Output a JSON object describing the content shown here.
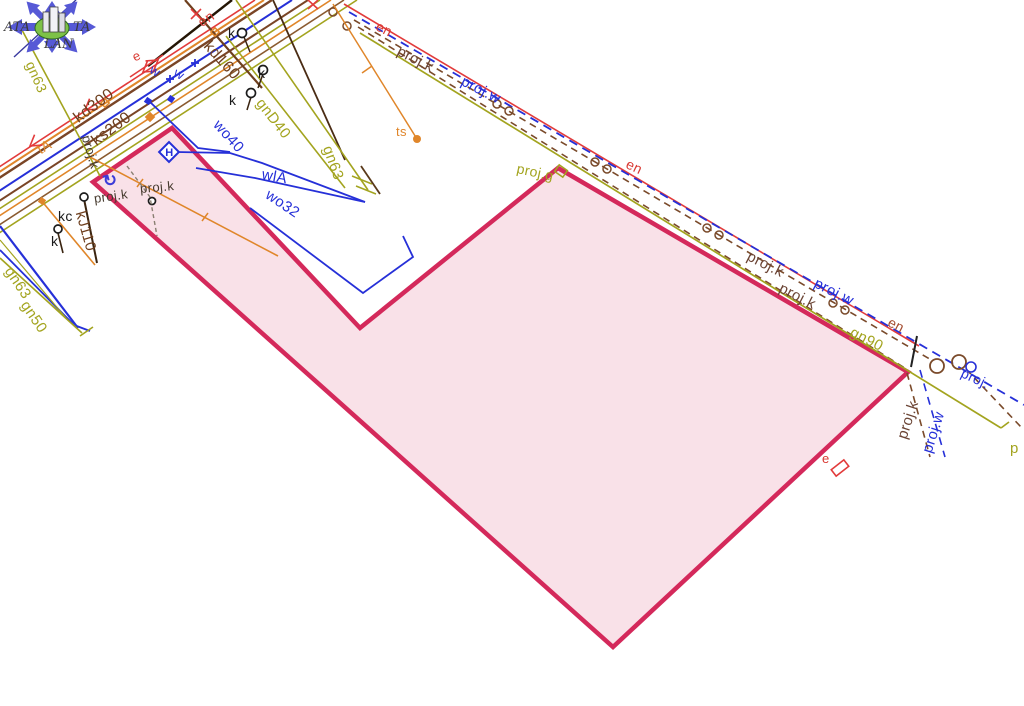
{
  "logo": {
    "left": "ATA",
    "right": "TA",
    "bottom": "LAN"
  },
  "map": {
    "colors": {
      "olive": "#a3a41f",
      "brown": "#6e3f1e",
      "projbrown": "#6b4434",
      "blue": "#2630d8",
      "red": "#d93a33",
      "darkred": "#a34b2e",
      "orange": "#e0862a",
      "dark": "#463a2e",
      "black": "#1c1c1c",
      "parcel_stroke": "#d4295b",
      "parcel_fill": "rgba(212,41,91,0.14)"
    },
    "symbols": {
      "hydrant_glyph": "H",
      "rotate_glyph": "↻"
    },
    "labels": [
      {
        "id": "gn63-a",
        "text": "gn63",
        "x": 30,
        "y": 62,
        "r": 66,
        "c": "olive",
        "s": 14
      },
      {
        "id": "en-a",
        "text": "en",
        "x": 199,
        "y": 23,
        "r": -33,
        "c": "red",
        "s": 14
      },
      {
        "id": "kd300",
        "text": "kd300",
        "x": 76,
        "y": 120,
        "r": -37,
        "c": "brown",
        "s": 16
      },
      {
        "id": "ks200",
        "text": "ks200",
        "x": 94,
        "y": 143,
        "r": -37,
        "c": "brown",
        "s": 16
      },
      {
        "id": "kd160",
        "text": "kd160",
        "x": 206,
        "y": 44,
        "r": 48,
        "c": "brown",
        "s": 16
      },
      {
        "id": "tA",
        "text": "tA",
        "x": 38,
        "y": 150,
        "r": -30,
        "c": "orange",
        "s": 14
      },
      {
        "id": "projk-rot-left",
        "text": "proj.k",
        "x": 86,
        "y": 135,
        "r": 74,
        "c": "dark",
        "s": 13
      },
      {
        "id": "projk-left-1",
        "text": "proj.k",
        "x": 94,
        "y": 198,
        "r": -8,
        "c": "dark",
        "s": 13
      },
      {
        "id": "projk-left-2",
        "text": "proj.k",
        "x": 140,
        "y": 188,
        "r": -5,
        "c": "dark",
        "s": 13
      },
      {
        "id": "k-1",
        "text": "k",
        "x": 228,
        "y": 33,
        "r": 0,
        "c": "black",
        "s": 14
      },
      {
        "id": "k-2",
        "text": "k",
        "x": 258,
        "y": 73,
        "r": 0,
        "c": "black",
        "s": 14
      },
      {
        "id": "k-3",
        "text": "k",
        "x": 229,
        "y": 100,
        "r": 0,
        "c": "black",
        "s": 14
      },
      {
        "id": "kc",
        "text": "kc",
        "x": 58,
        "y": 216,
        "r": 0,
        "c": "black",
        "s": 14
      },
      {
        "id": "k-4",
        "text": "k",
        "x": 51,
        "y": 241,
        "r": 0,
        "c": "black",
        "s": 14
      },
      {
        "id": "gnD40",
        "text": "gnD40",
        "x": 259,
        "y": 100,
        "r": 52,
        "c": "olive",
        "s": 15
      },
      {
        "id": "gn63-b",
        "text": "gn63",
        "x": 327,
        "y": 146,
        "r": 70,
        "c": "olive",
        "s": 15
      },
      {
        "id": "wo40",
        "text": "wo40",
        "x": 216,
        "y": 122,
        "r": 48,
        "c": "blue",
        "s": 15
      },
      {
        "id": "wlA",
        "text": "wlA",
        "x": 262,
        "y": 174,
        "r": 10,
        "c": "blue",
        "s": 15
      },
      {
        "id": "wo32",
        "text": "wo32",
        "x": 267,
        "y": 193,
        "r": 34,
        "c": "blue",
        "s": 15
      },
      {
        "id": "w-1",
        "text": "w",
        "x": 151,
        "y": 68,
        "r": 30,
        "c": "blue",
        "s": 13
      },
      {
        "id": "w-2",
        "text": "w",
        "x": 175,
        "y": 71,
        "r": 30,
        "c": "blue",
        "s": 13
      },
      {
        "id": "e-a",
        "text": "e",
        "x": 133,
        "y": 57,
        "r": -25,
        "c": "red",
        "s": 13
      },
      {
        "id": "ts",
        "text": "ts",
        "x": 396,
        "y": 131,
        "r": 0,
        "c": "orange",
        "s": 13
      },
      {
        "id": "en-b",
        "text": "en",
        "x": 377,
        "y": 25,
        "r": 27,
        "c": "red",
        "s": 14
      },
      {
        "id": "projk-b1",
        "text": "proj.k",
        "x": 398,
        "y": 50,
        "r": 27,
        "c": "projbrown",
        "s": 15
      },
      {
        "id": "projw-b1",
        "text": "proj.w",
        "x": 462,
        "y": 80,
        "r": 27,
        "c": "blue",
        "s": 15
      },
      {
        "id": "projg",
        "text": "proj.g",
        "x": 517,
        "y": 168,
        "r": 12,
        "c": "olive",
        "s": 14
      },
      {
        "id": "en-c",
        "text": "en",
        "x": 627,
        "y": 163,
        "r": 25,
        "c": "red",
        "s": 14
      },
      {
        "id": "projk-b2",
        "text": "proj.k",
        "x": 748,
        "y": 255,
        "r": 27,
        "c": "projbrown",
        "s": 15
      },
      {
        "id": "projk-b3",
        "text": "proj.k",
        "x": 780,
        "y": 287,
        "r": 27,
        "c": "projbrown",
        "s": 15
      },
      {
        "id": "projw-b2",
        "text": "proj.w",
        "x": 815,
        "y": 282,
        "r": 27,
        "c": "blue",
        "s": 15
      },
      {
        "id": "en-d",
        "text": "en",
        "x": 889,
        "y": 321,
        "r": 27,
        "c": "darkred",
        "s": 14
      },
      {
        "id": "gn90",
        "text": "gn90",
        "x": 851,
        "y": 331,
        "r": 27,
        "c": "olive",
        "s": 15
      },
      {
        "id": "proj-e",
        "text": "proj.",
        "x": 962,
        "y": 372,
        "r": 25,
        "c": "blue",
        "s": 14
      },
      {
        "id": "projk-vert",
        "text": "proj.k",
        "x": 902,
        "y": 438,
        "r": -72,
        "c": "projbrown",
        "s": 15
      },
      {
        "id": "projw-vert",
        "text": "proj.w",
        "x": 927,
        "y": 452,
        "r": -72,
        "c": "blue",
        "s": 15
      },
      {
        "id": "p-bottomright",
        "text": "p",
        "x": 1010,
        "y": 448,
        "r": 0,
        "c": "olive",
        "s": 15
      },
      {
        "id": "e-b",
        "text": "e",
        "x": 822,
        "y": 458,
        "r": 0,
        "c": "red",
        "s": 13
      },
      {
        "id": "kJ110",
        "text": "kJ110",
        "x": 80,
        "y": 211,
        "r": 74,
        "c": "brown",
        "s": 15
      },
      {
        "id": "gn63-c",
        "text": "gn63",
        "x": 8,
        "y": 268,
        "r": 56,
        "c": "olive",
        "s": 15
      },
      {
        "id": "gn50",
        "text": "gn50",
        "x": 24,
        "y": 302,
        "r": 56,
        "c": "olive",
        "s": 15
      }
    ]
  }
}
